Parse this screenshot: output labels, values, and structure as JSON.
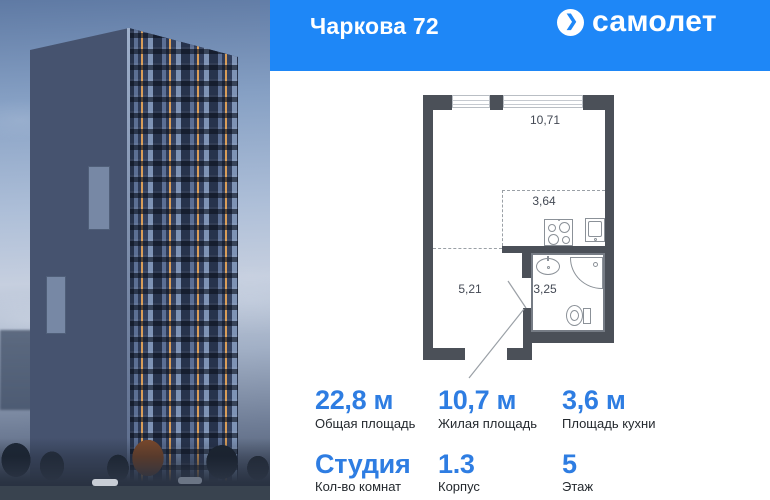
{
  "header": {
    "project_name": "Чаркова 72",
    "brand_name": "самолет",
    "brand_icon": "chevron-right-in-circle",
    "brand_icon_glyph": "❯"
  },
  "floor_plan": {
    "living_room_area": "10,71",
    "kitchen_zone_area": "3,64",
    "hallway_area": "5,21",
    "bathroom_area": "3,25"
  },
  "stats": {
    "total_area": {
      "value": "22,8 м",
      "label": "Общая площадь"
    },
    "living_area": {
      "value": "10,7 м",
      "label": "Жилая площадь"
    },
    "kitchen_area": {
      "value": "3,6 м",
      "label": "Площадь кухни"
    },
    "rooms": {
      "value": "Студия",
      "label": "Кол-во комнат"
    },
    "building": {
      "value": "1.3",
      "label": "Корпус"
    },
    "floor": {
      "value": "5",
      "label": "Этаж"
    }
  },
  "colors": {
    "header_blue": "#1e87f7",
    "stat_value_blue": "#2e7de2",
    "plan_wall_gray": "#4b5058"
  }
}
